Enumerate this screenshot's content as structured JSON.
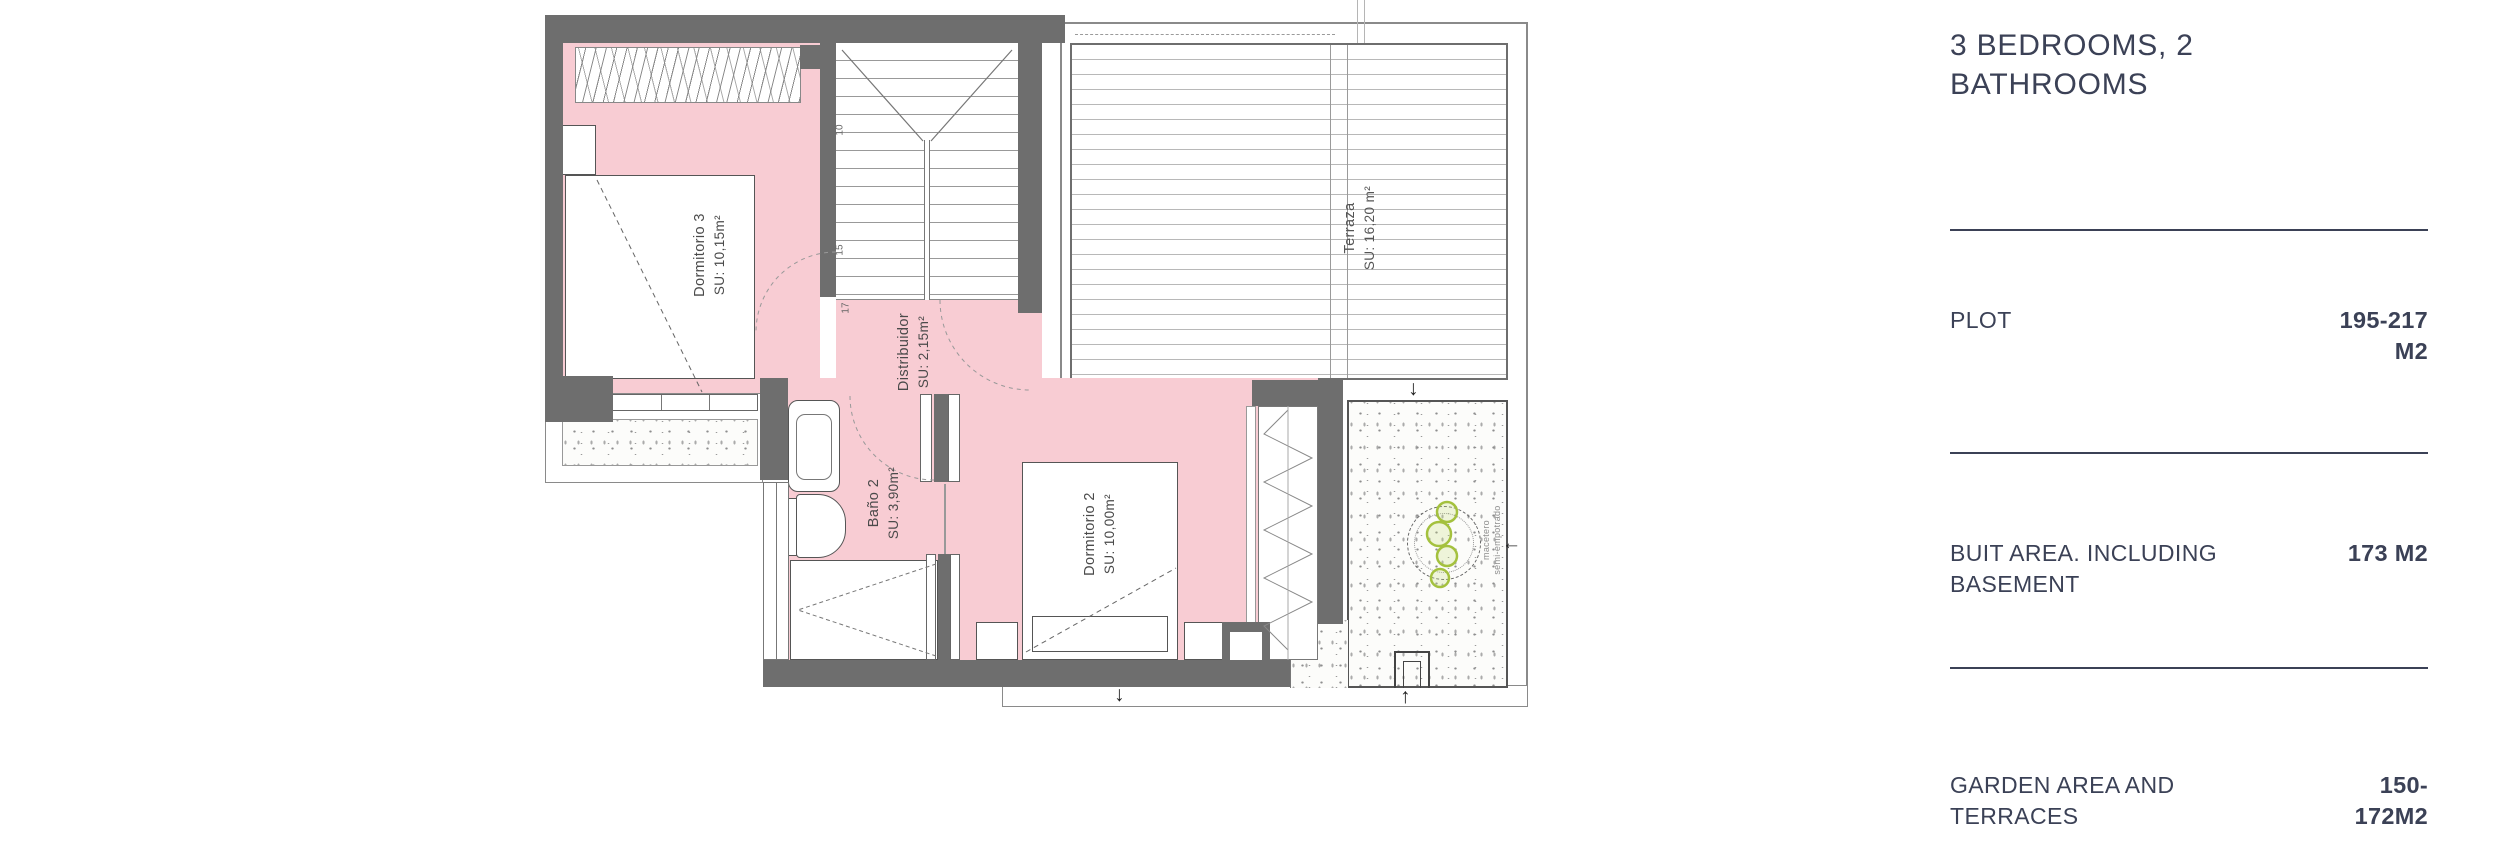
{
  "panel": {
    "title": "3 BEDROOMS, 2 BATHROOMS",
    "rows": [
      {
        "label": "PLOT",
        "value": "195-217 M2"
      },
      {
        "label": "BUIT AREA. INCLUDING BASEMENT",
        "value": "173 M2"
      },
      {
        "label": "GARDEN AREA AND TERRACES",
        "value": "150-172M2"
      }
    ],
    "text_color": "#3b4156"
  },
  "plan": {
    "rooms": [
      {
        "name": "Dormitorio 3",
        "area": "SU: 10,15m²"
      },
      {
        "name": "Distribuidor",
        "area": "SU: 2,15m²"
      },
      {
        "name": "Baño 2",
        "area": "SU: 3,90m²"
      },
      {
        "name": "Dormitorio 2",
        "area": "SU: 10,00m²"
      },
      {
        "name": "Terraza",
        "area": "SU: 16,20 m²"
      }
    ],
    "stair_numbers": [
      "10",
      "15",
      "17"
    ],
    "garden_planter_label": [
      "macetero",
      "semi-empotrado"
    ],
    "icons": {
      "arrow_down": "↓",
      "arrow_up": "↑",
      "arrow_left": "←"
    },
    "colors": {
      "room_pink": "#f8ccd3",
      "wall_gray": "#6e6e6e",
      "plant_green": "#a4c13e",
      "accent_navy": "#3b4156"
    }
  }
}
